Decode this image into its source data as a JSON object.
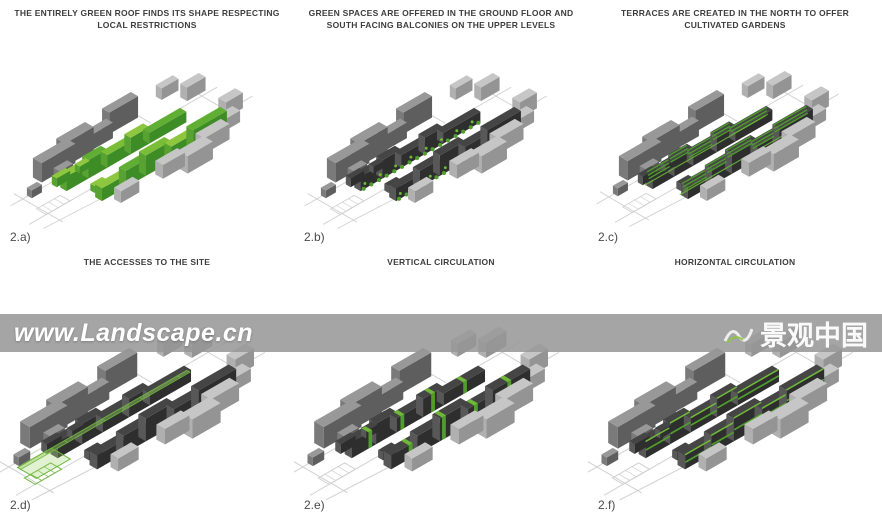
{
  "page": {
    "width": 882,
    "height": 526,
    "background": "#ffffff"
  },
  "panels": [
    {
      "id": "2a",
      "label": "2.a)",
      "caption": "THE ENTIRELY GREEN ROOF FINDS ITS SHAPE RESPECTING LOCAL RESTRICTIONS",
      "variant": "green-roof"
    },
    {
      "id": "2b",
      "label": "2.b)",
      "caption": "GREEN SPACES ARE OFFERED IN THE GROUND FLOOR AND SOUTH FACING BALCONIES ON THE UPPER LEVELS",
      "variant": "balconies"
    },
    {
      "id": "2c",
      "label": "2.c)",
      "caption": "TERRACES ARE CREATED IN THE NORTH TO OFFER CULTIVATED GARDENS",
      "variant": "terraces"
    },
    {
      "id": "2d",
      "label": "2.d)",
      "caption": "THE ACCESSES TO THE SITE",
      "variant": "accesses"
    },
    {
      "id": "2e",
      "label": "2.e)",
      "caption": "VERTICAL CIRCULATION",
      "variant": "vertical"
    },
    {
      "id": "2f",
      "label": "2.f)",
      "caption": "HORIZONTAL CIRCULATION",
      "variant": "horizontal"
    }
  ],
  "watermark": {
    "left_text": "www.Landscape.cn",
    "right_text": "景观中国",
    "logo_icon": "landscape-swoosh-icon"
  },
  "colors": {
    "caption_text": "#3d3d3d",
    "label_text": "#4a4a4a",
    "street": "#cfcfcf",
    "context_dark": {
      "t": "#989898",
      "f": "#5e5e5e",
      "e": "#7a7a7a"
    },
    "context_light": {
      "t": "#c6c6c6",
      "f": "#949494",
      "e": "#b0b0b0"
    },
    "slab_dark": {
      "t": "#454545",
      "f": "#2e2e2e",
      "e": "#585858"
    },
    "green_tops": [
      "#8ec63f",
      "#60ae33",
      "#7abd37"
    ],
    "green_front": "#3e8c26",
    "green_end": "#58a231",
    "overlay_green": "#4f9e2c",
    "overlay_green_light": "#6fb838",
    "access_fill": "rgba(154,205,98,0.45)",
    "access_fill2": "rgba(154,205,98,0.28)",
    "access_stroke": "#6ab53b",
    "watermark_band": "rgba(150,150,150,0.86)",
    "watermark_text": "#ffffff"
  }
}
